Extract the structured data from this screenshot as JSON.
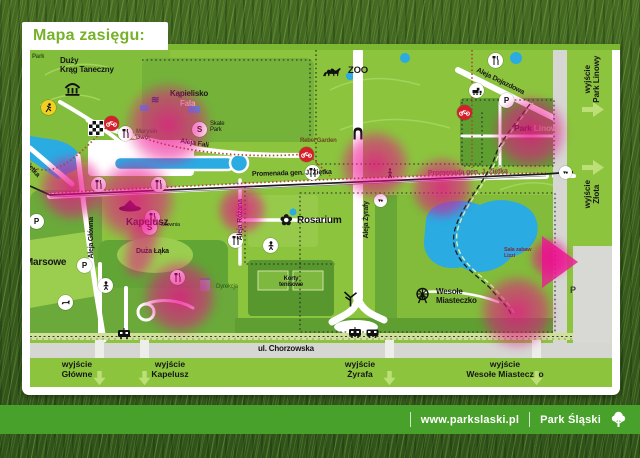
{
  "title": "Mapa zasięgu:",
  "colors": {
    "map_green": "#8cc43e",
    "forest_green": "#61a535",
    "water_blue": "#2aabe2",
    "coverage_pink": "#ec0a8c",
    "brand_green": "#76b22a",
    "footer_green": "#48a12a"
  },
  "map": {
    "areas": {
      "park_corner": "Park",
      "duzy_krag": "Duży\nKrąg Taneczny",
      "kapielisko": "Kąpielisko",
      "kapielisko_fala": "Fala",
      "skate_park": "Skate\nPark",
      "marysin_dwor": "Marysin\nDwór",
      "zoo": "ZOO",
      "rebel_garden": "Rebel Garden",
      "park_linowy_a": "Park ",
      "park_linowy_b": "Linowy",
      "kapelusz": "Kapelusz",
      "silownia": "Siłownia",
      "duza_laka": "Duża Łąka",
      "pola_marsowe": "Pola Marsowe",
      "rosarium": "Rosarium",
      "korty": "Korty\ntenisowe",
      "wesole": "Wesołe\nMiasteczko",
      "dyrekcja": "Dyrekcja",
      "sala_zabaw": "Sala zabaw\nLizzi"
    },
    "streets": {
      "promenada": "Promenada gen. J. Ziętka",
      "zietka": "Ziętka",
      "aleja_fali": "Aleja Fali",
      "aleja_glowna": "Aleja Główna",
      "aleja_rozana": "Aleja Różana",
      "aleja_zyrafy": "Aleja Żyrafy",
      "aleja_dojazdowa": "Aleja Dojazdowa",
      "chorzowska": "ul. Chorzowska"
    },
    "exits_bottom": [
      "wyjście\nGłówne",
      "wyjście\nKapelusz",
      "wyjście\nŻyrafa",
      "wyjście\nWesołe Miasteczko"
    ],
    "exits_right": [
      "wyjście\nPark Linowy",
      "wyjście\nZłota"
    ],
    "icon_glyphs": {
      "parking": "P",
      "sport": "S",
      "viewpoint": "▾●",
      "wave": "≋",
      "rose": "✿"
    }
  },
  "footer": {
    "website": "www.parkslaski.pl",
    "brand": "Park Śląski"
  }
}
